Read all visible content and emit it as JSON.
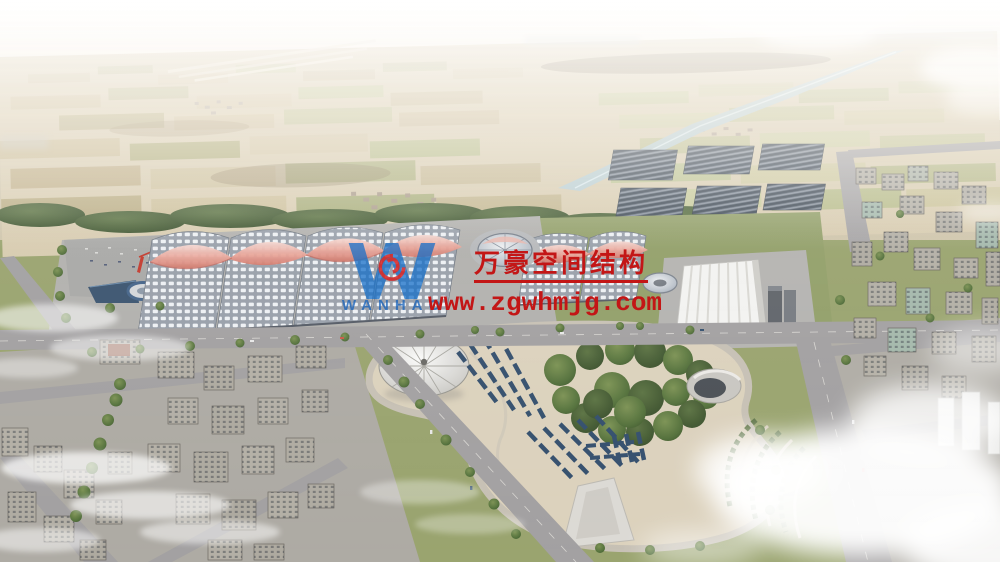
{
  "watermark": {
    "logo_text": "WANHAO",
    "company_name": "万豪空间结构",
    "website": "www.zgwhmjg.com",
    "red": "#c31616",
    "blue": "#1a72c8"
  },
  "scene": {
    "type": "aerial-architectural-rendering",
    "landmarks": [
      "wave-roof-exhibition-halls",
      "central-dome-plaza",
      "pleated-roof-convention-hall",
      "kidney-shaped-park",
      "silver-tent-dome",
      "cone-pavilion",
      "solar-panel-farm",
      "river-canal",
      "farmland-horizon",
      "city-blocks",
      "low-clouds"
    ],
    "palette": {
      "sky": "#f8f5ef",
      "farmland": "#d8ccb0",
      "grass": "#9aa46f",
      "trees": "#54713c",
      "road": "#a3a1a2",
      "plaza_sand": "#dcd2bd",
      "hall_roof": "#9aa1ab",
      "hall_ridge_pink": "#e4988c",
      "river": "#b7ccd3",
      "solar_panel": "#3c4753",
      "buildings": "#b2aea5",
      "convention_white": "#f3f3f1"
    }
  }
}
